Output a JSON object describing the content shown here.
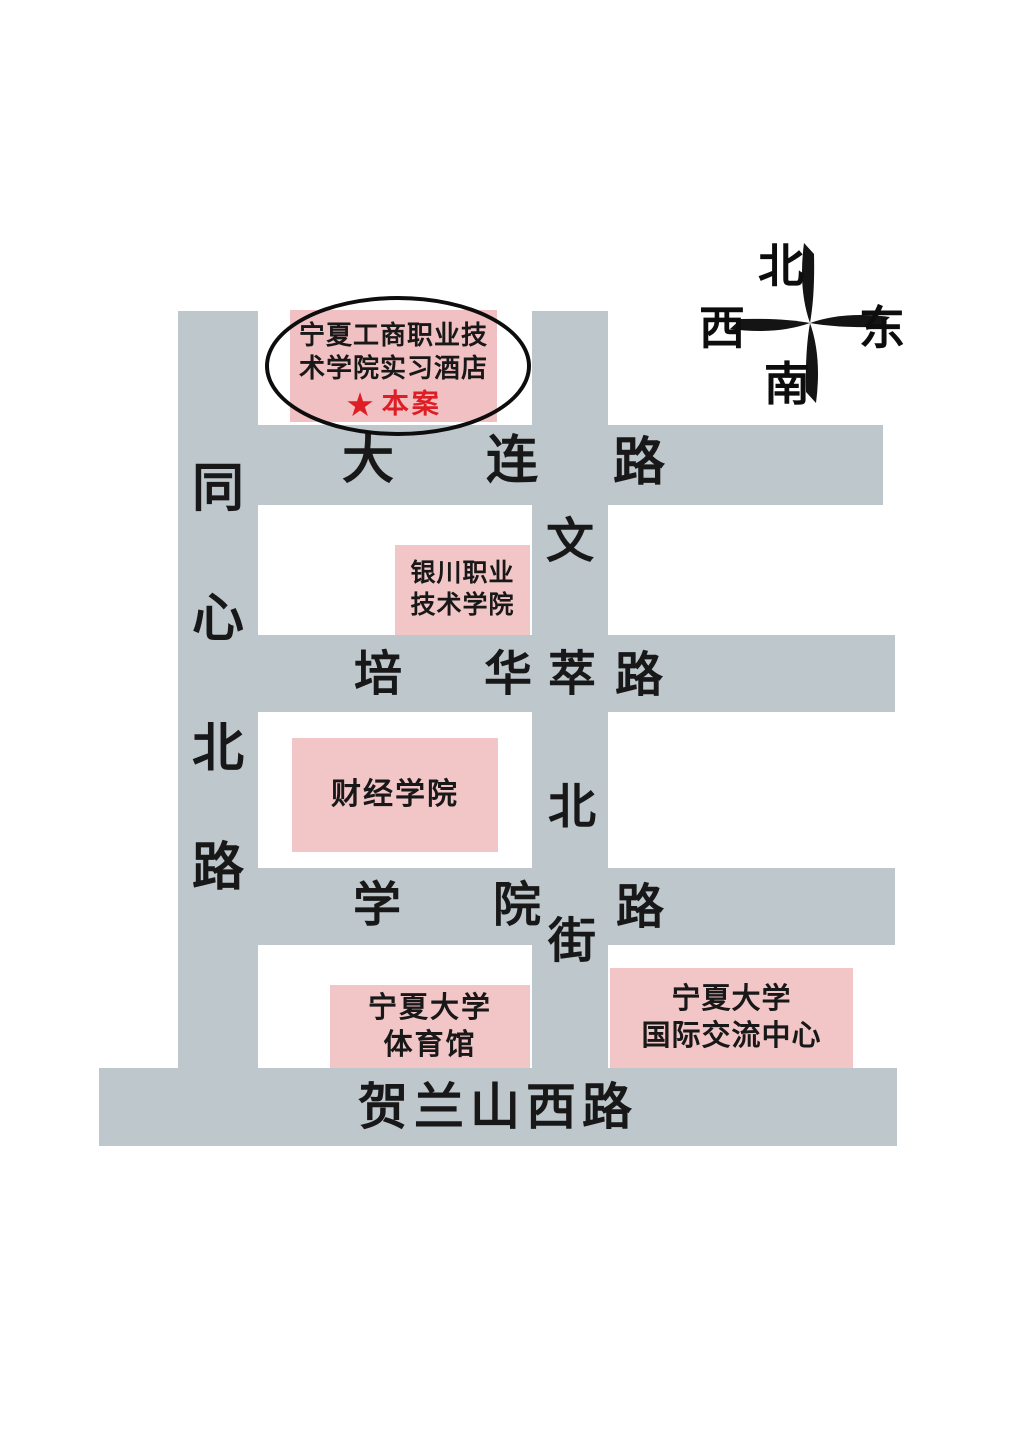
{
  "colors": {
    "road": "#bdc7cc",
    "building": "#f2c5c7",
    "marker_red": "#dd1e25",
    "text": "#181818"
  },
  "compass": {
    "north": "北",
    "south": "南",
    "east": "东",
    "west": "西"
  },
  "roads": {
    "dalian": {
      "name": "大连路",
      "chars": [
        "大",
        "连",
        "路"
      ]
    },
    "peihua": {
      "name": "培华路",
      "chars": [
        "培",
        "华",
        "路"
      ]
    },
    "xueyuan": {
      "name": "学院路",
      "chars": [
        "学",
        "院",
        "路"
      ]
    },
    "tongxin": {
      "name": "同心北路",
      "chars": [
        "同",
        "心",
        "北",
        "路"
      ]
    },
    "wencui": {
      "name": "文萃北街",
      "chars": [
        "文",
        "萃",
        "北",
        "街"
      ]
    },
    "helanshan": {
      "label": "贺兰山西路"
    }
  },
  "buildings": {
    "hotel": {
      "line1": "宁夏工商职业技",
      "line2": "术学院实习酒店",
      "marker_star": "★",
      "marker_label": "本案"
    },
    "yinchuan_vocational": {
      "line1": "银川职业",
      "line2": "技术学院"
    },
    "finance_college": {
      "label": "财经学院"
    },
    "nxu_gym": {
      "line1": "宁夏大学",
      "line2": "体育馆"
    },
    "nxu_intl_center": {
      "line1": "宁夏大学",
      "line2": "国际交流中心"
    }
  }
}
